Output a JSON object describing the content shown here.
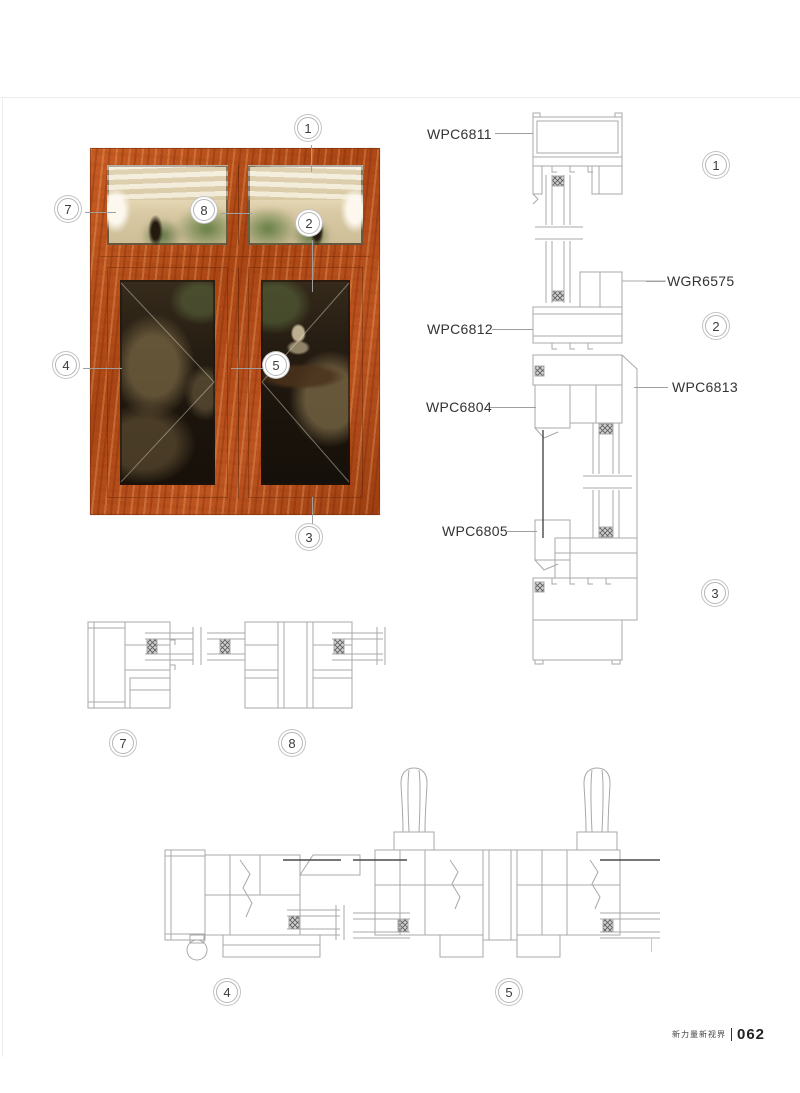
{
  "photo_callouts": {
    "c1": "1",
    "c2": "2",
    "c3": "3",
    "c4": "4",
    "c5": "5",
    "c7": "7",
    "c8": "8"
  },
  "vertical_section": {
    "labels": {
      "wpc6811": "WPC6811",
      "wgr6575": "WGR6575",
      "wpc6812": "WPC6812",
      "wpc6813": "WPC6813",
      "wpc6804": "WPC6804",
      "wpc6805": "WPC6805"
    },
    "circles": {
      "s1": "1",
      "s2": "2",
      "s3": "3"
    }
  },
  "plan_sections": {
    "circles": {
      "s7": "7",
      "s8": "8",
      "s4": "4",
      "s5": "5"
    }
  },
  "footer": {
    "slogan": "新力量新视界",
    "page_number": "062"
  },
  "colors": {
    "wood": "#b04c1a",
    "drawing_line": "#a8a8a8",
    "label_text": "#333333"
  }
}
